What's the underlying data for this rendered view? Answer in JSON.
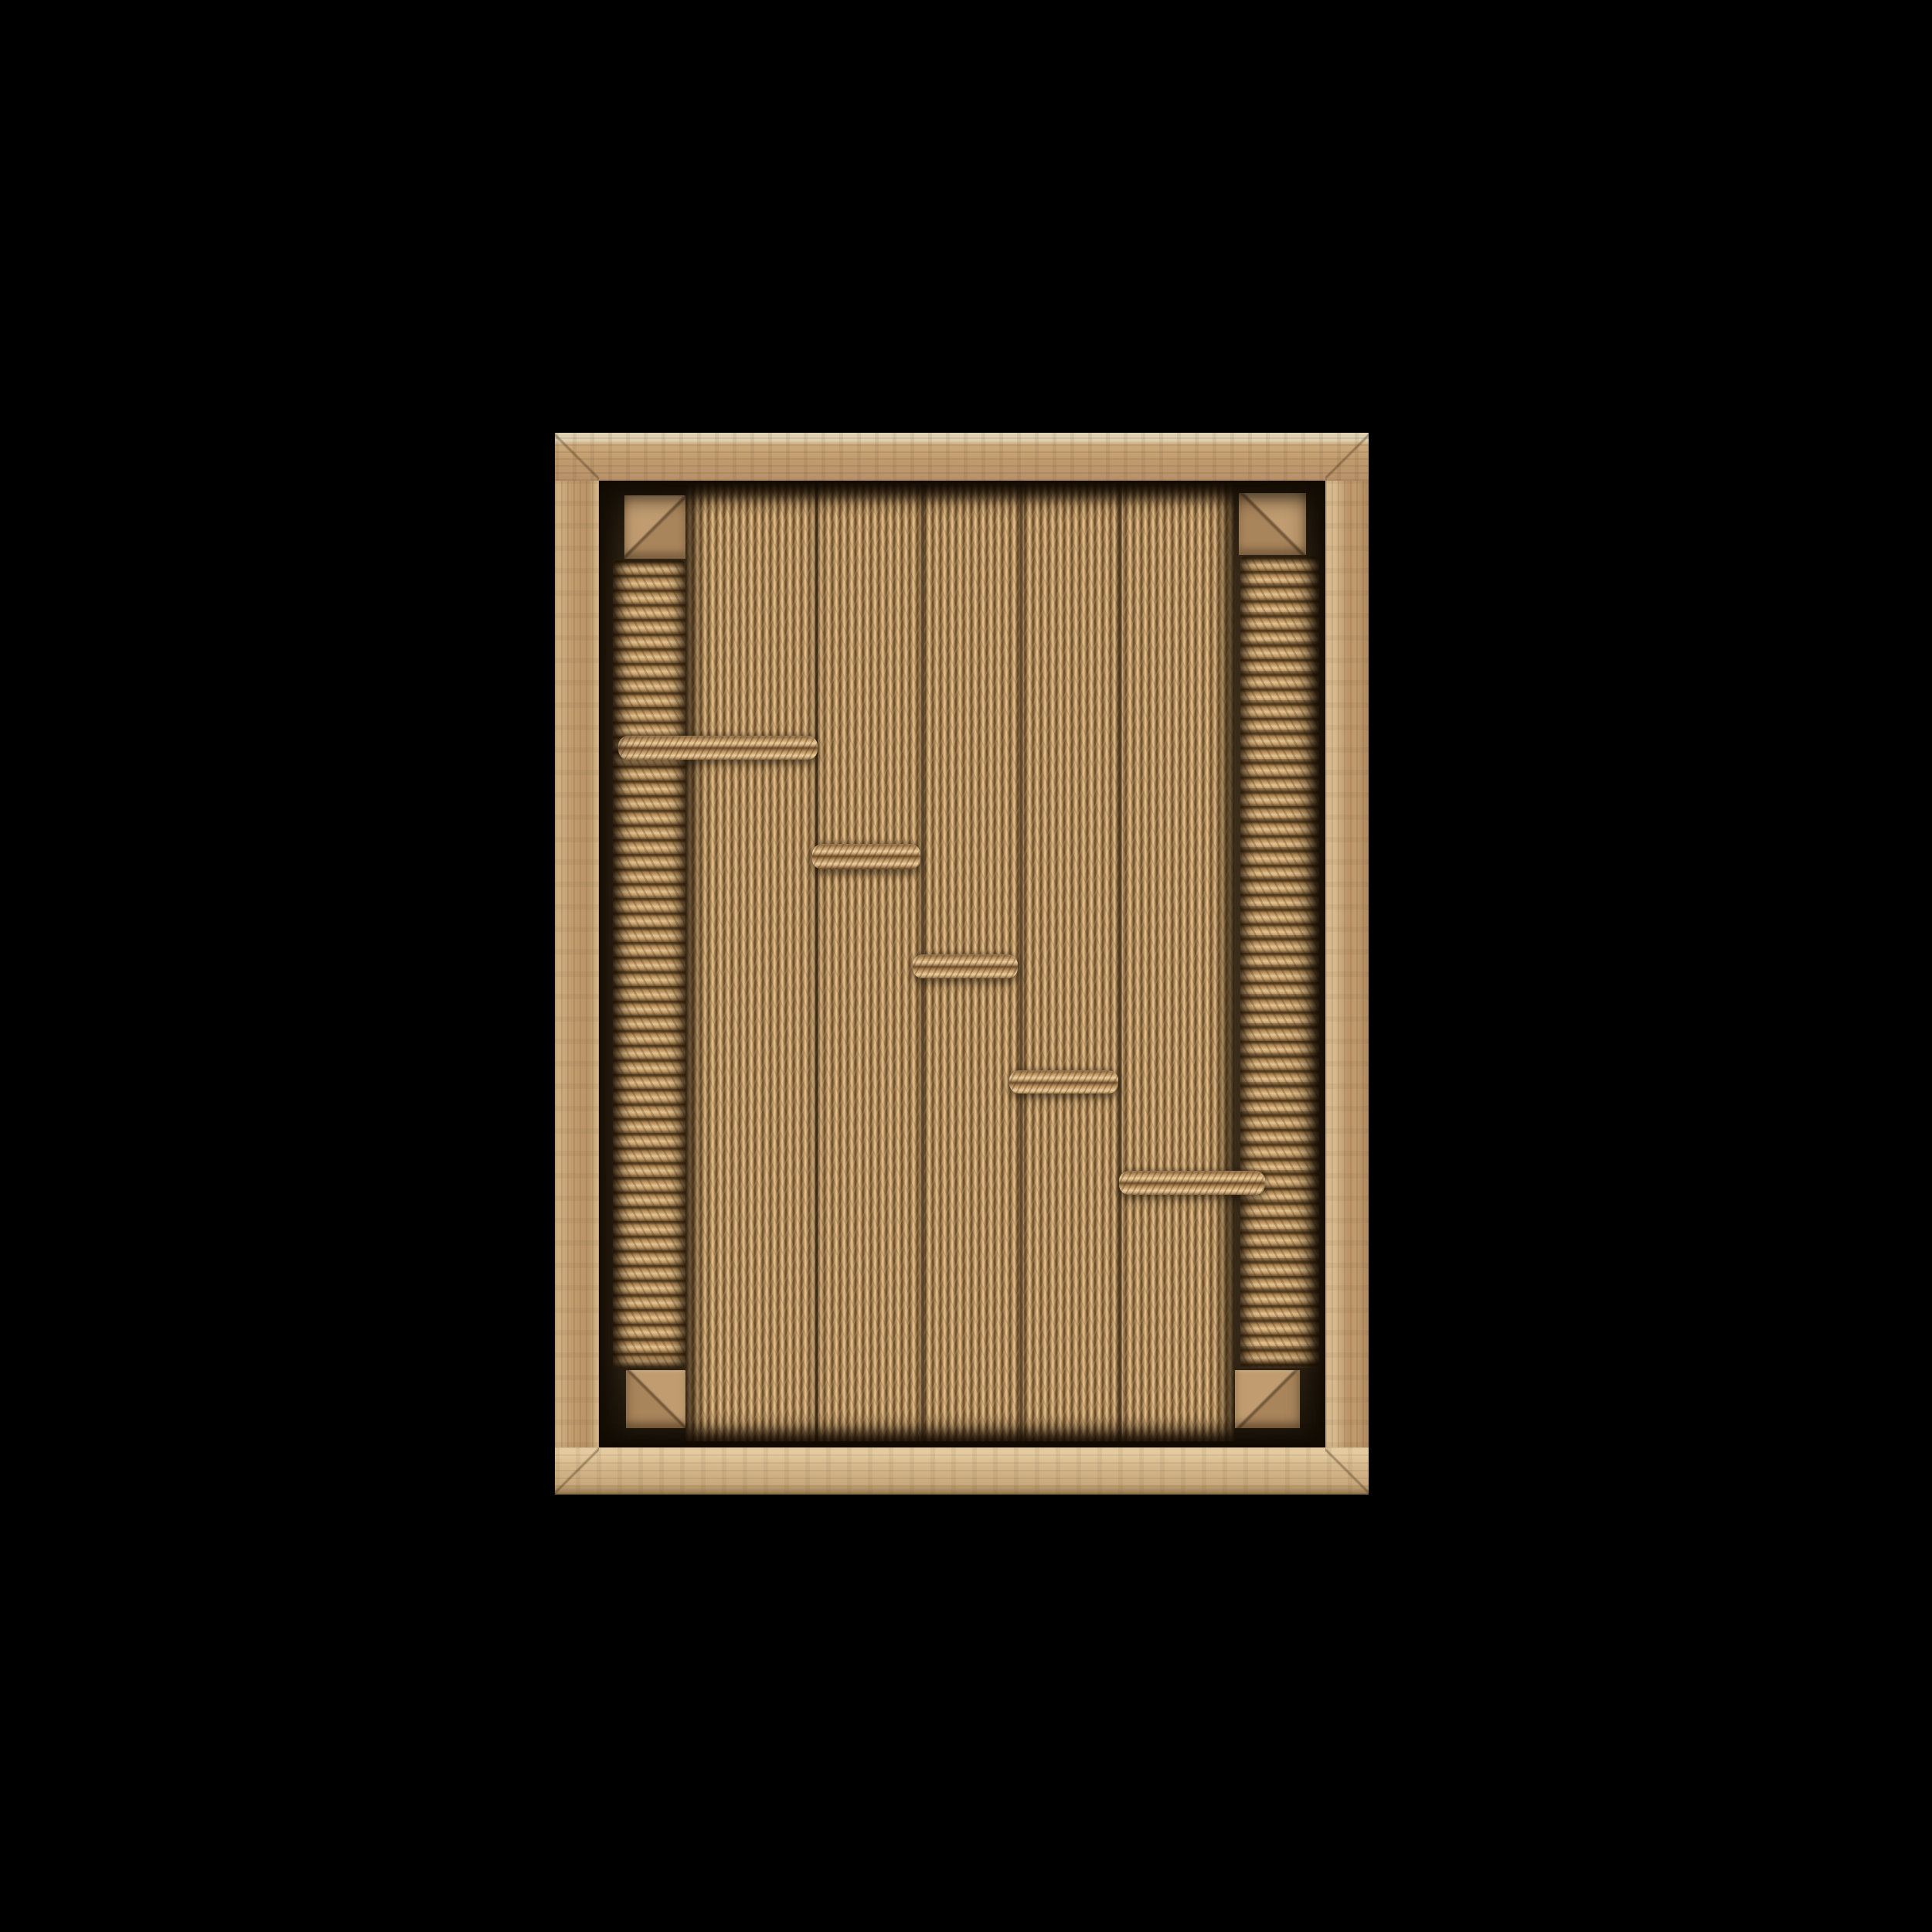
{
  "scene": {
    "description": "Oak shadow-box wall frame containing a woven natural paper-cord panel: vertical cord bundles bound by five stepped horizontal cord bars, flanked left and right by columns of horizontally wrapped cord over mitered inner oak rails, photographed on a black background",
    "background": "#000000"
  },
  "palette": {
    "background": "#000000",
    "frame_wood": "#c19c6e",
    "frame_highlight": "#ddd1b2",
    "frame_bevel": "#d7ba8e",
    "frame_bottom": "#d5b88c",
    "opening_shadow": "#3a2c1a",
    "rail_wood": "#b6926a",
    "cord_light": "#e4c492",
    "cord_mid": "#c9a470",
    "cord_dark": "#6d5030",
    "seam_dark": "#46311a"
  }
}
